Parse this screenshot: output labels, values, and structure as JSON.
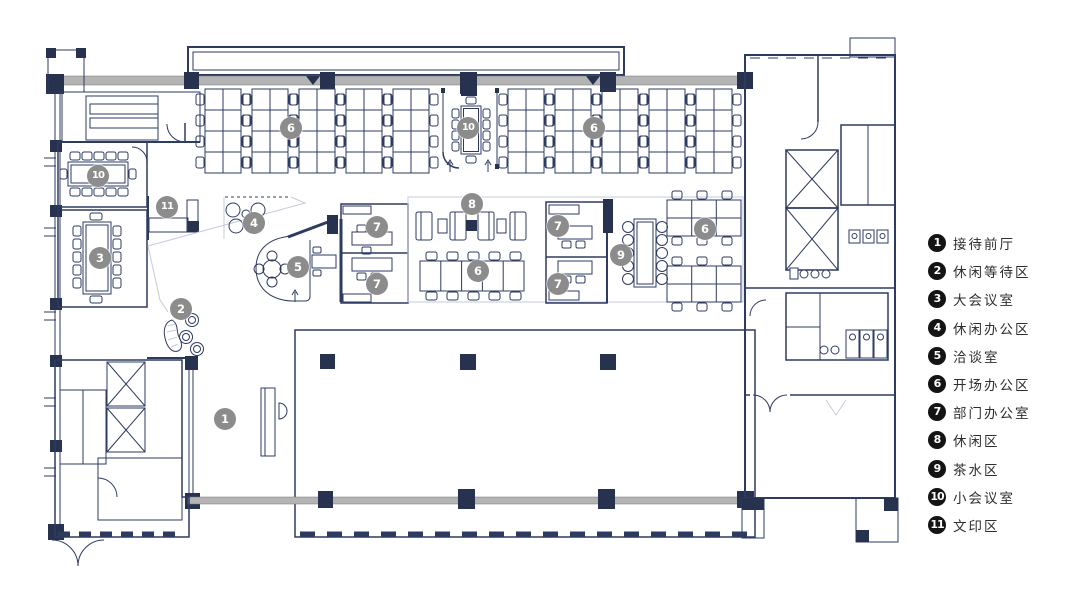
{
  "title": "office-floor-plan",
  "legend": {
    "items": [
      {
        "num": "1",
        "label": "接待前厅"
      },
      {
        "num": "2",
        "label": "休闲等待区"
      },
      {
        "num": "3",
        "label": "大会议室"
      },
      {
        "num": "4",
        "label": "休闲办公区"
      },
      {
        "num": "5",
        "label": "洽谈室"
      },
      {
        "num": "6",
        "label": "开场办公区"
      },
      {
        "num": "7",
        "label": "部门办公室"
      },
      {
        "num": "8",
        "label": "休闲区"
      },
      {
        "num": "9",
        "label": "茶水区"
      },
      {
        "num": "10",
        "label": "小会议室"
      },
      {
        "num": "11",
        "label": "文印区"
      }
    ]
  },
  "plan": {
    "markers": [
      {
        "num": "6",
        "x": 291,
        "y": 128
      },
      {
        "num": "10",
        "x": 468,
        "y": 128
      },
      {
        "num": "6",
        "x": 594,
        "y": 128
      },
      {
        "num": "10",
        "x": 98,
        "y": 176
      },
      {
        "num": "11",
        "x": 167,
        "y": 207
      },
      {
        "num": "4",
        "x": 254,
        "y": 223
      },
      {
        "num": "3",
        "x": 100,
        "y": 258
      },
      {
        "num": "7",
        "x": 377,
        "y": 227
      },
      {
        "num": "8",
        "x": 472,
        "y": 204
      },
      {
        "num": "7",
        "x": 558,
        "y": 226
      },
      {
        "num": "6",
        "x": 705,
        "y": 229
      },
      {
        "num": "9",
        "x": 621,
        "y": 255
      },
      {
        "num": "5",
        "x": 298,
        "y": 267
      },
      {
        "num": "6",
        "x": 478,
        "y": 271
      },
      {
        "num": "7",
        "x": 377,
        "y": 284
      },
      {
        "num": "7",
        "x": 558,
        "y": 284
      },
      {
        "num": "2",
        "x": 181,
        "y": 309
      },
      {
        "num": "1",
        "x": 225,
        "y": 419
      }
    ]
  },
  "colors": {
    "wall": "#2e3b60",
    "dark": "#27324f",
    "hatch_line": "#96a0bf",
    "hatch_bg": "#fbfaf2",
    "band": "#b4b4b4",
    "marker": "#8c8c8c",
    "badge": "#141414",
    "text": "#2e2e2e"
  }
}
